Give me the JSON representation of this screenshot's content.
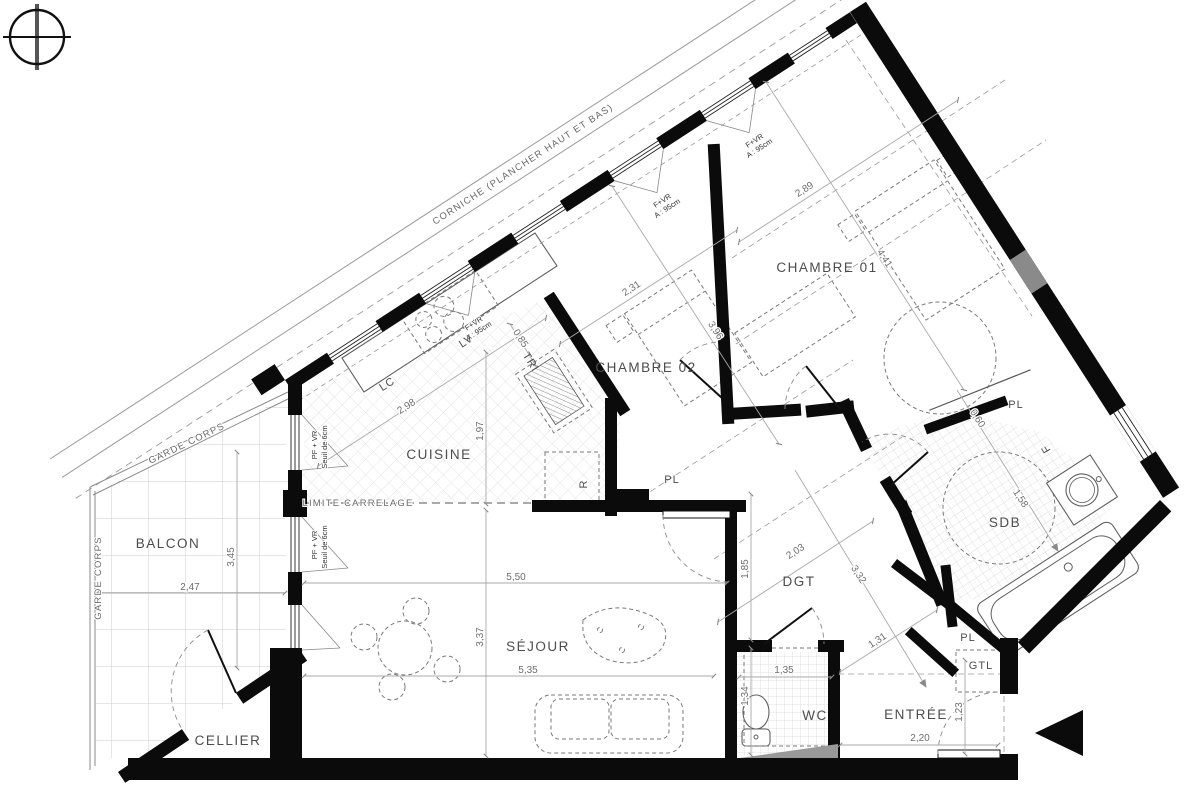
{
  "annotations": {
    "corniche": "CORNICHE (PLANCHER HAUT ET BAS)",
    "garde_corps": "GARDE CORPS",
    "limite_carrelage": "LIMITE CARRELAGE"
  },
  "rooms": {
    "balcon": "BALCON",
    "cellier": "CELLIER",
    "sejour": "SÉJOUR",
    "cuisine": "CUISINE",
    "chambre02": "CHAMBRE 02",
    "chambre01": "CHAMBRE 01",
    "sdb": "SDB",
    "wc": "WC",
    "entree": "ENTRÉE",
    "dgt": "DGT",
    "placard": "PL",
    "gtl": "GTL"
  },
  "equipment": {
    "lave_linge": "LC",
    "lave_vaisselle": "LV",
    "tri": "TRI",
    "refrigerateur": "R",
    "fenetre": "F"
  },
  "windows": {
    "fenetre_volet": "F+VR",
    "fenetre_volet_hauteur": "A : 95cm",
    "porte_fenetre": "PF + VR",
    "porte_fenetre_seuil": "Seuil de 6cm"
  },
  "dimensions": {
    "balcon_largeur": "2,47",
    "balcon_profondeur": "3,45",
    "sejour_largeur_haut": "5,50",
    "sejour_hauteur": "3,37",
    "sejour_largeur_bas": "5,35",
    "cuisine_largeur": "2,98",
    "cuisine_profondeur": "1,97",
    "cuisine_niche": "0,85",
    "chambre02_largeur": "2,31",
    "chambre02_profondeur": "3,96",
    "chambre01_largeur": "2,89",
    "chambre01_profondeur": "4,41",
    "dgt_largeur": "2,03",
    "dgt_hauteur": "1,85",
    "dgt_diagonale": "3,32",
    "sdb_placard": "0,60",
    "sdb_profondeur": "1,58",
    "wc_largeur": "1,35",
    "wc_profondeur": "1,34",
    "entree_diagonale": "1,31",
    "entree_largeur": "2,20",
    "entree_hauteur": "1,23"
  }
}
